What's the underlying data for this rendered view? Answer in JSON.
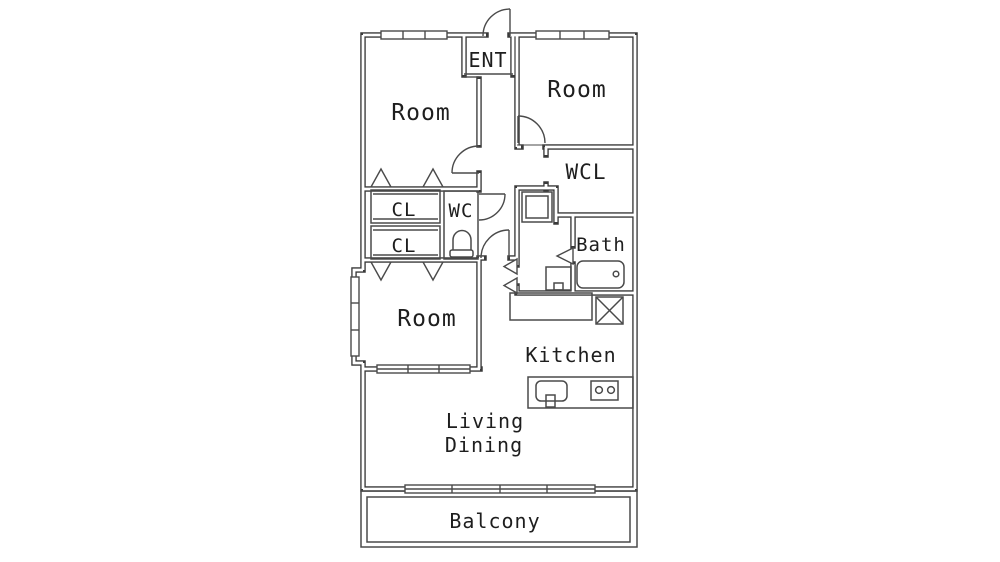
{
  "floorplan": {
    "type": "apartment-floor-plan",
    "colors": {
      "background": "#ffffff",
      "wall": "#3a3a3a",
      "thin_line": "#4a4a4a",
      "text": "#1e1e1e"
    },
    "labels": {
      "ent": "ENT",
      "room_nw": "Room",
      "room_ne": "Room",
      "wcl": "WCL",
      "cl_upper": "CL",
      "cl_lower": "CL",
      "wc": "WC",
      "bath": "Bath",
      "room_sw": "Room",
      "kitchen": "Kitchen",
      "living": "Living",
      "dining": "Dining",
      "balcony": "Balcony"
    },
    "fixtures": [
      {
        "icon": "entrance-door-arc"
      },
      {
        "icon": "hinged-door-arc"
      },
      {
        "icon": "folding-door-triangles"
      },
      {
        "icon": "toilet"
      },
      {
        "icon": "washing-machine"
      },
      {
        "icon": "washbasin"
      },
      {
        "icon": "bathtub"
      },
      {
        "icon": "refrigerator-space-x"
      },
      {
        "icon": "kitchen-sink"
      },
      {
        "icon": "stove-two-burners"
      },
      {
        "icon": "closet-fold-marks"
      },
      {
        "icon": "sliding-window"
      },
      {
        "icon": "bay-window"
      }
    ]
  }
}
